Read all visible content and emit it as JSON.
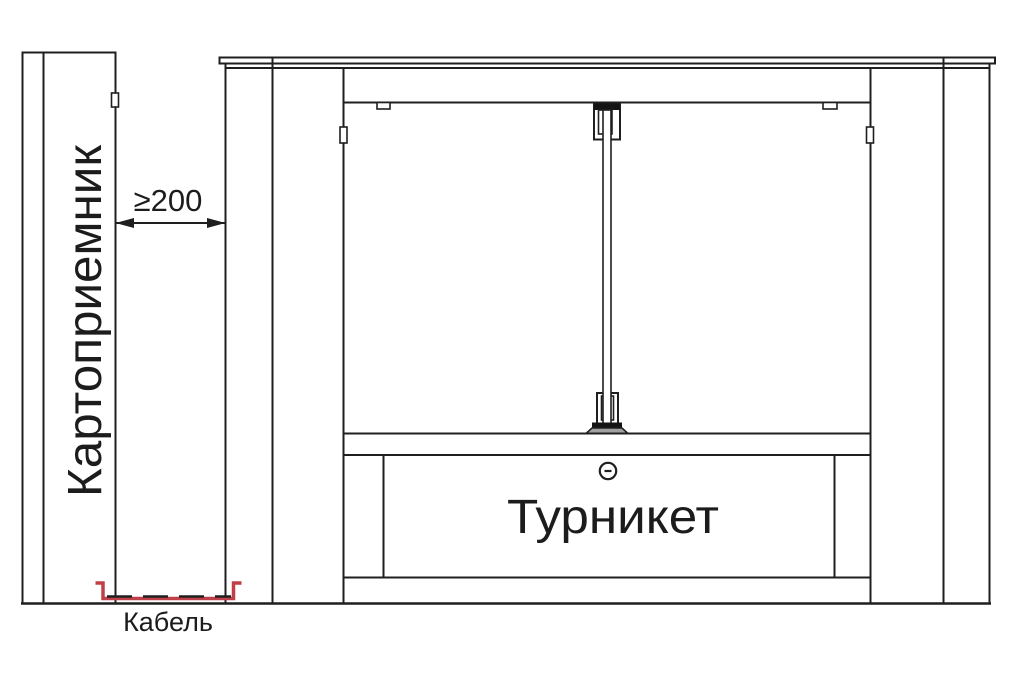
{
  "diagram": {
    "card_reader": {
      "label": "Картоприемник"
    },
    "dimension": {
      "label": "≥200"
    },
    "turnstile": {
      "label": "Турникет"
    },
    "cable": {
      "label": "Кабель"
    },
    "colors": {
      "line": "#1f1f1f",
      "cable_red": "#bf4049",
      "base_gray": "#a0a0a0",
      "background": "#ffffff"
    }
  }
}
